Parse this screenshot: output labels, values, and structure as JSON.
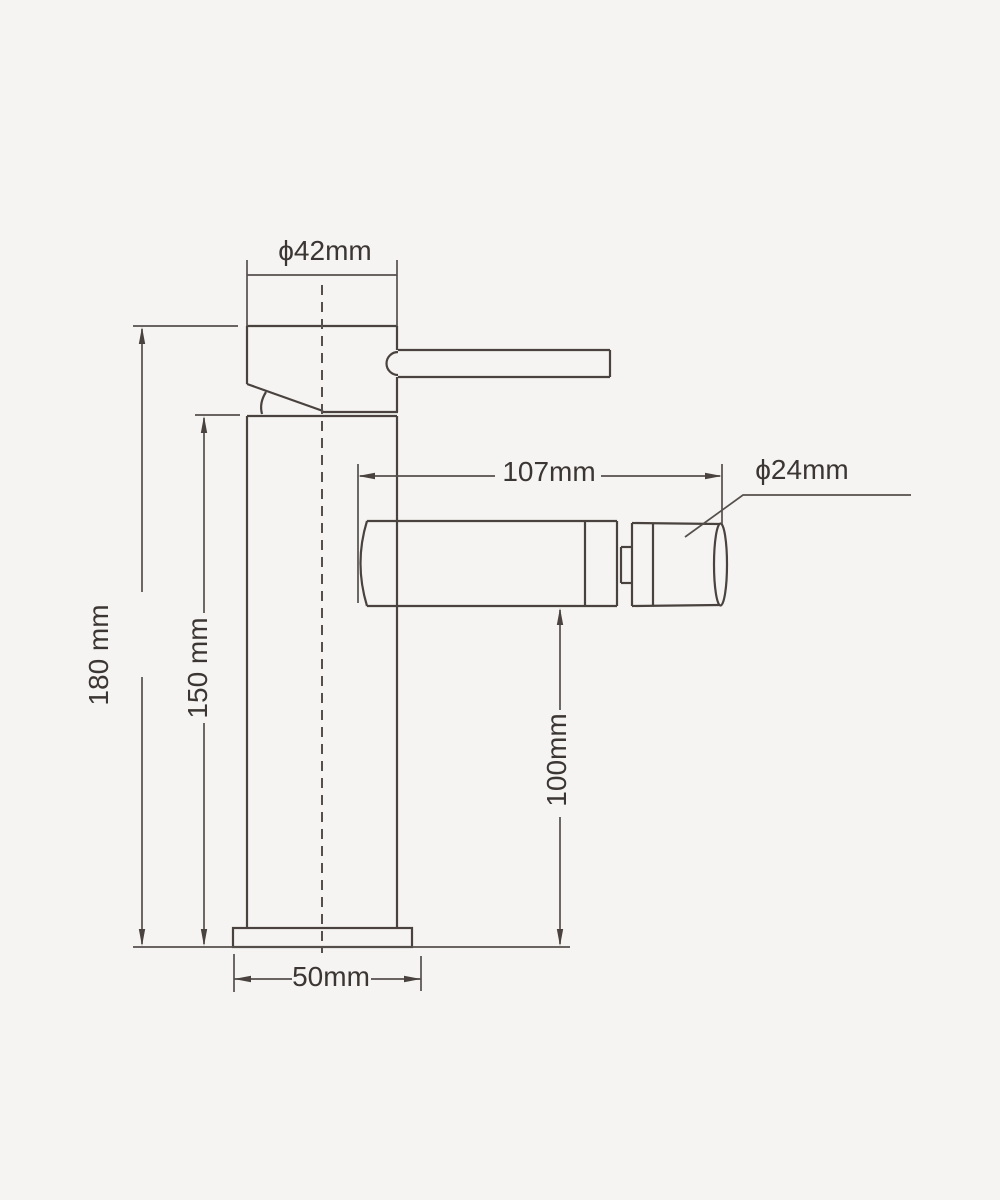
{
  "drawing": {
    "type": "technical-dimension-drawing",
    "subject": "single-lever-basin-mixer-faucet-side-view",
    "background_color": "#f5f4f2",
    "object_line_color": "#49423e",
    "dimension_line_color": "#55504c",
    "text_color": "#3b3633"
  },
  "labels": {
    "head_diameter": "ϕ42mm",
    "total_height": "180 mm",
    "body_height": "150 mm",
    "spout_reach": "107mm",
    "spout_diameter": "ϕ24mm",
    "spout_outlet_height": "100mm",
    "base_width": "50mm"
  }
}
